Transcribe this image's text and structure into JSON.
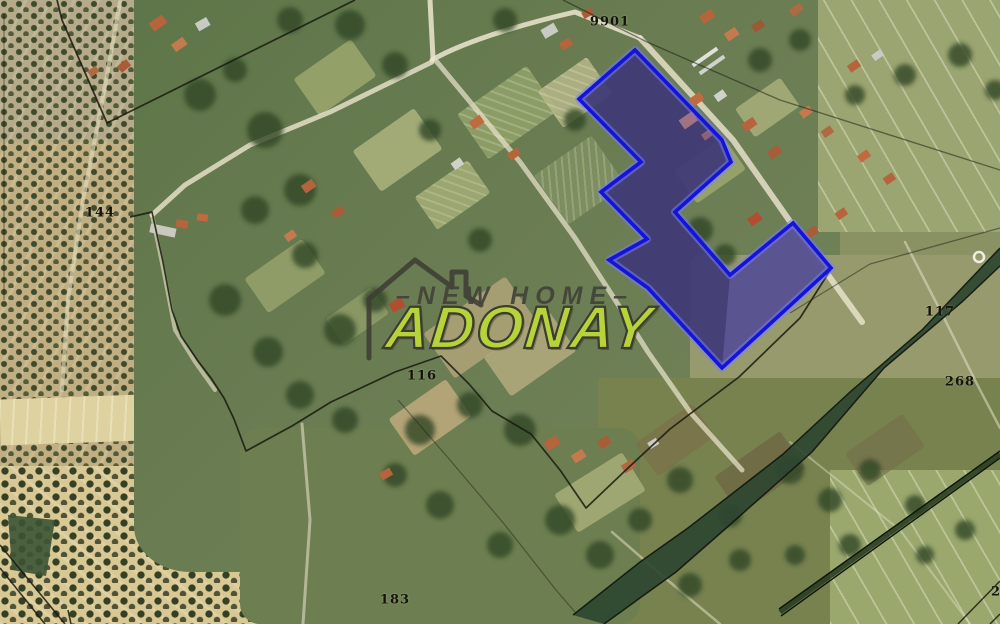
{
  "map": {
    "parcel_labels": [
      {
        "id": "9901",
        "text": "9901",
        "x": 610,
        "y": 22
      },
      {
        "id": "144",
        "text": "144",
        "x": 100,
        "y": 213
      },
      {
        "id": "116",
        "text": "116",
        "x": 422,
        "y": 376
      },
      {
        "id": "117",
        "text": "117",
        "x": 940,
        "y": 312
      },
      {
        "id": "268",
        "text": "268",
        "x": 960,
        "y": 382
      },
      {
        "id": "183",
        "text": "183",
        "x": 395,
        "y": 600
      },
      {
        "id": "2",
        "text": "2",
        "x": 996,
        "y": 592
      }
    ],
    "highlight_parcel": {
      "points": [
        [
          635,
          50
        ],
        [
          722,
          140
        ],
        [
          731,
          162
        ],
        [
          675,
          212
        ],
        [
          730,
          275
        ],
        [
          793,
          223
        ],
        [
          831,
          268
        ],
        [
          722,
          368
        ],
        [
          648,
          288
        ],
        [
          609,
          260
        ],
        [
          647,
          239
        ],
        [
          601,
          192
        ],
        [
          641,
          162
        ],
        [
          579,
          99
        ]
      ],
      "stroke_color": "#1313dc",
      "glow_color": "rgba(120,125,255,0.5)",
      "fill_color": "rgba(43,40,160,0.48)"
    },
    "watermark": {
      "line1": "–NEW HOME–",
      "line2": "ADONAY",
      "text_color": "#43433a",
      "accent_color": "#b6d339",
      "outline_color": "#3c3c30"
    }
  }
}
